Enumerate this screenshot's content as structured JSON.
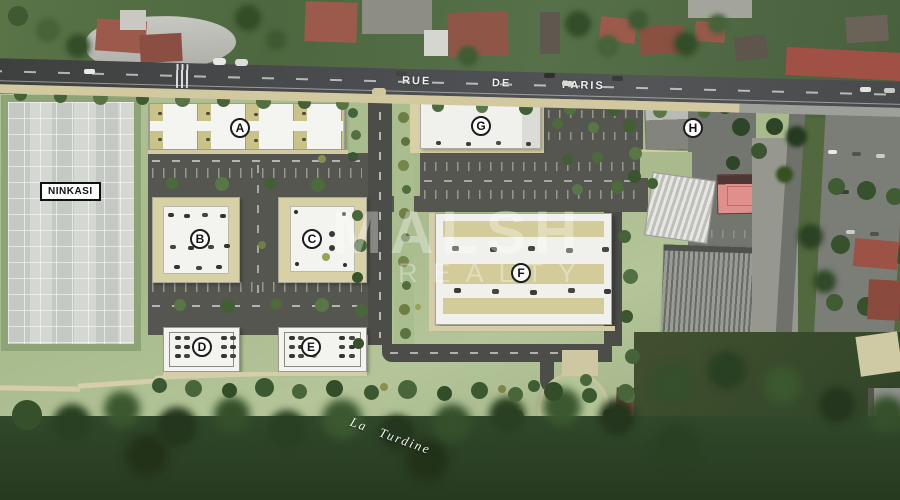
{
  "scene": {
    "type": "aerial-development-masterplan",
    "street_label": {
      "rue": "RUE",
      "de": "DE",
      "paris": "PARIS"
    },
    "river_label": "La Turdine",
    "existing_building_label": "NINKASI",
    "watermark": {
      "line1": "MALSH",
      "line2": "REALTY"
    },
    "markers": [
      {
        "label": "A"
      },
      {
        "label": "B"
      },
      {
        "label": "C"
      },
      {
        "label": "D"
      },
      {
        "label": "E"
      },
      {
        "label": "F"
      },
      {
        "label": "G"
      },
      {
        "label": "H"
      }
    ],
    "colors": {
      "lawn": "#adbf93",
      "plan_asphalt": "#55564f",
      "main_road": "#46484a",
      "building_white": "#f3f3ef",
      "building_beige": "#d8d1a5",
      "forest": "#31482a",
      "court_red": "#e0908c",
      "ninkasi_gray": "#d4d8d3"
    }
  }
}
